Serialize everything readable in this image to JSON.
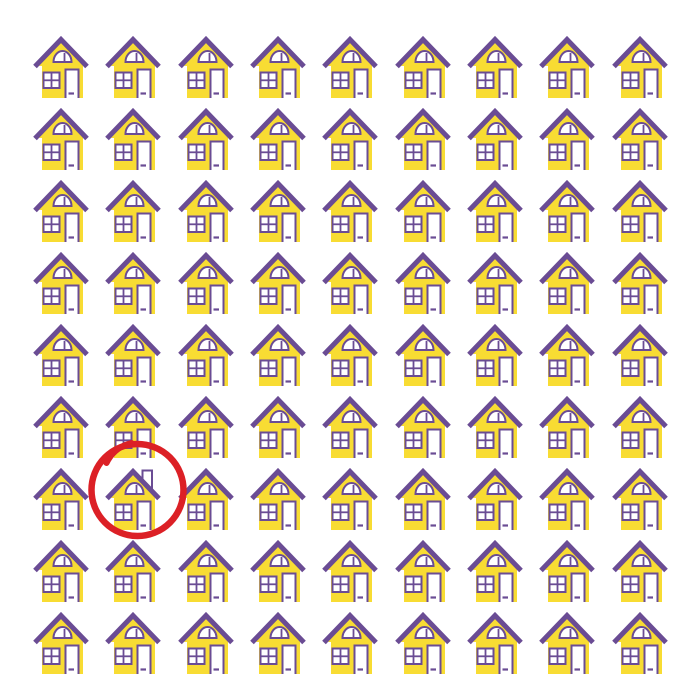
{
  "puzzle": {
    "type": "odd-one-out",
    "description": "Grid of identical houses; find the one that is different",
    "grid": {
      "rows": 9,
      "cols": 9,
      "total_houses": 81
    },
    "odd_house": {
      "row": 7,
      "col": 2,
      "difference": "chimney on right roof slope"
    },
    "annotation": {
      "type": "hand-drawn-circle",
      "row": 7,
      "col": 2,
      "stroke_width": 6.5,
      "radius": 46
    }
  },
  "icons": {
    "normal_house": "house-icon",
    "odd_house": "house-with-chimney-icon",
    "annotation": "red-circle-annotation"
  },
  "colors": {
    "background": "#ffffff",
    "house_fill": "#F8DC33",
    "outline_purple": "#6A4C94",
    "window_white": "#FFFFFF",
    "annotation_red": "#DC2026"
  }
}
